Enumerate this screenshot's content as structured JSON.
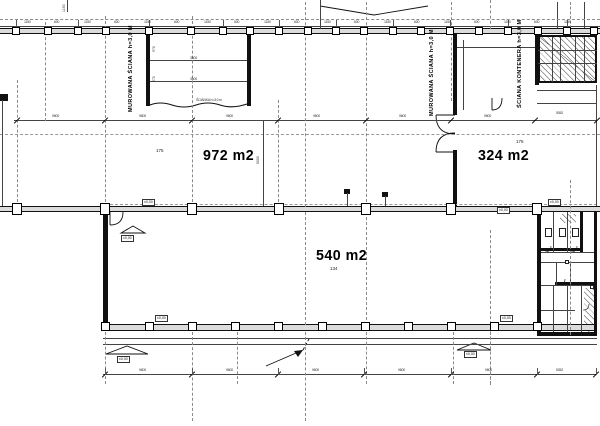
{
  "plan": {
    "rooms": [
      {
        "area": "972 m2",
        "note": "175"
      },
      {
        "area": "324 m2",
        "note": "176"
      },
      {
        "area": "540 m2",
        "note": "134"
      }
    ],
    "wall_labels": {
      "left": "MUROWANA ŚCIANA h=3,0 M",
      "mid": "MUROWANA ŚCIANA h=3,0 M",
      "container": "ŚCIANA KONTENERA h=3,0 M"
    },
    "levels": {
      "zero": "±0,00"
    },
    "dims": {
      "bay": "9600",
      "bay_end": "5052",
      "tick_a": "1150",
      "tick_b": "600",
      "side": "5000",
      "inner": "3600",
      "inner_v": "970",
      "break_note": "ŚCIANKA h=3,0 m"
    }
  }
}
